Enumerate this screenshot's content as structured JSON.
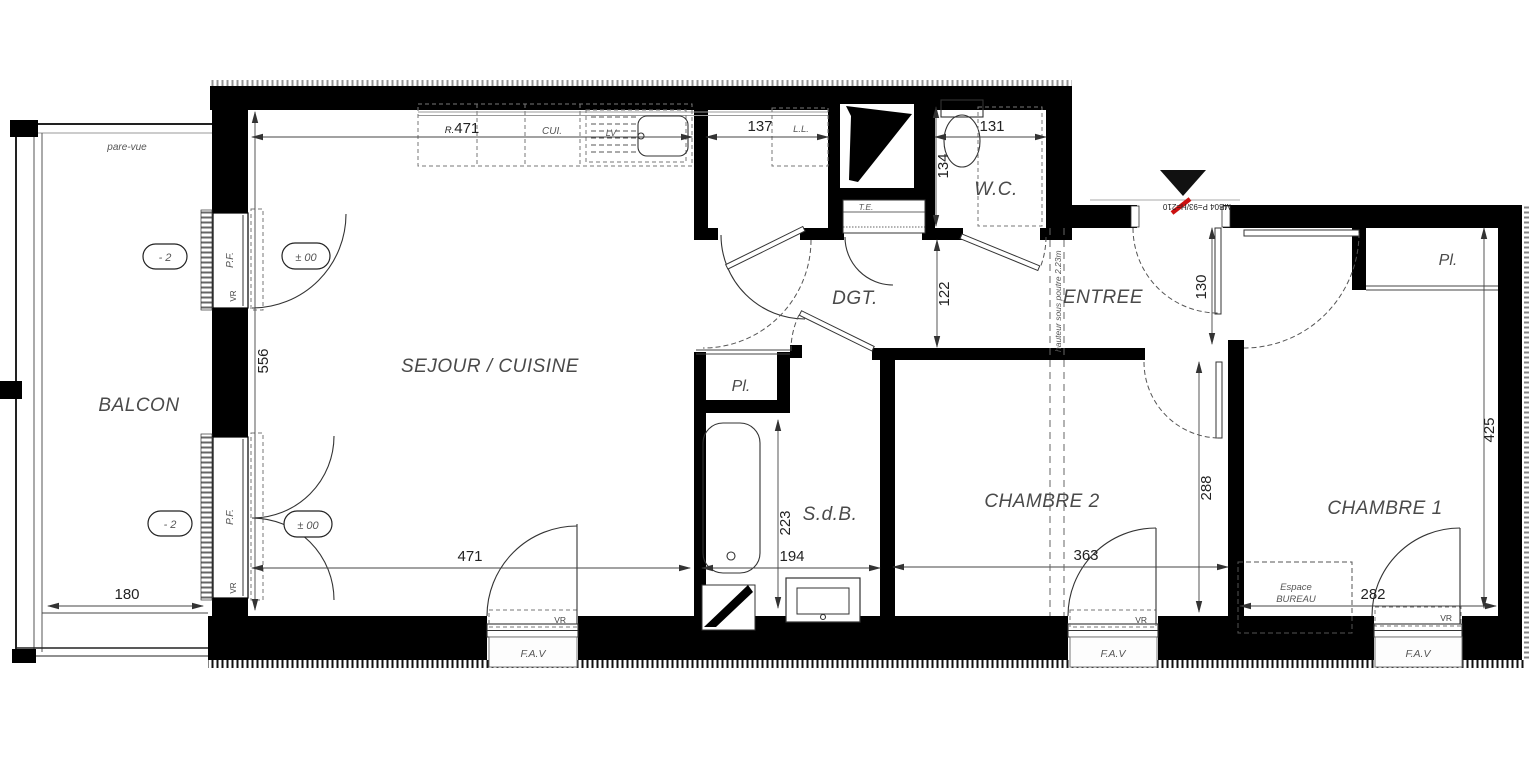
{
  "rooms": {
    "balcon": "BALCON",
    "sejour_cuisine": "SEJOUR / CUISINE",
    "degagement": "DGT.",
    "wc": "W.C.",
    "entree": "ENTREE",
    "salle_de_bain": "S.d.B.",
    "chambre2": "CHAMBRE 2",
    "chambre1": "CHAMBRE 1",
    "placard": "Pl."
  },
  "dims": {
    "prefix_r": "R.",
    "kitchen_run": "471",
    "sejour_depth": "556",
    "cellier_width": "137",
    "wc_width": "131",
    "wc_depth": "134",
    "degagement_width": "122",
    "entree_width": "130",
    "chambre2_depth": "288",
    "sdb_depth": "223",
    "sdb_width": "194",
    "sejour_width": "471",
    "chambre2_width": "363",
    "chambre1_width": "282",
    "chambre1_depth": "425",
    "balcon_depth": "180"
  },
  "labels": {
    "pare_vue": "pare-vue",
    "cuisine_abbr": "CUI.",
    "lave_vaisselle": "LV",
    "lave_linge": "L.L.",
    "tableau_elec": "T.E.",
    "porte_fenetre": "P.F.",
    "volet_roulant": "VR",
    "fav": "F.A.V",
    "beam_note": "hauteur sous poutre 2.23m",
    "door_ref": "MB04 P=93/H=210",
    "espace_line1": "Espace",
    "espace_line2": "BUREAU",
    "level_low": "- 2",
    "level_zero": "± 00"
  },
  "colors": {
    "wall": "#000000",
    "line": "#333333",
    "label": "#4a4a4a",
    "accent_red": "#cc1111"
  }
}
